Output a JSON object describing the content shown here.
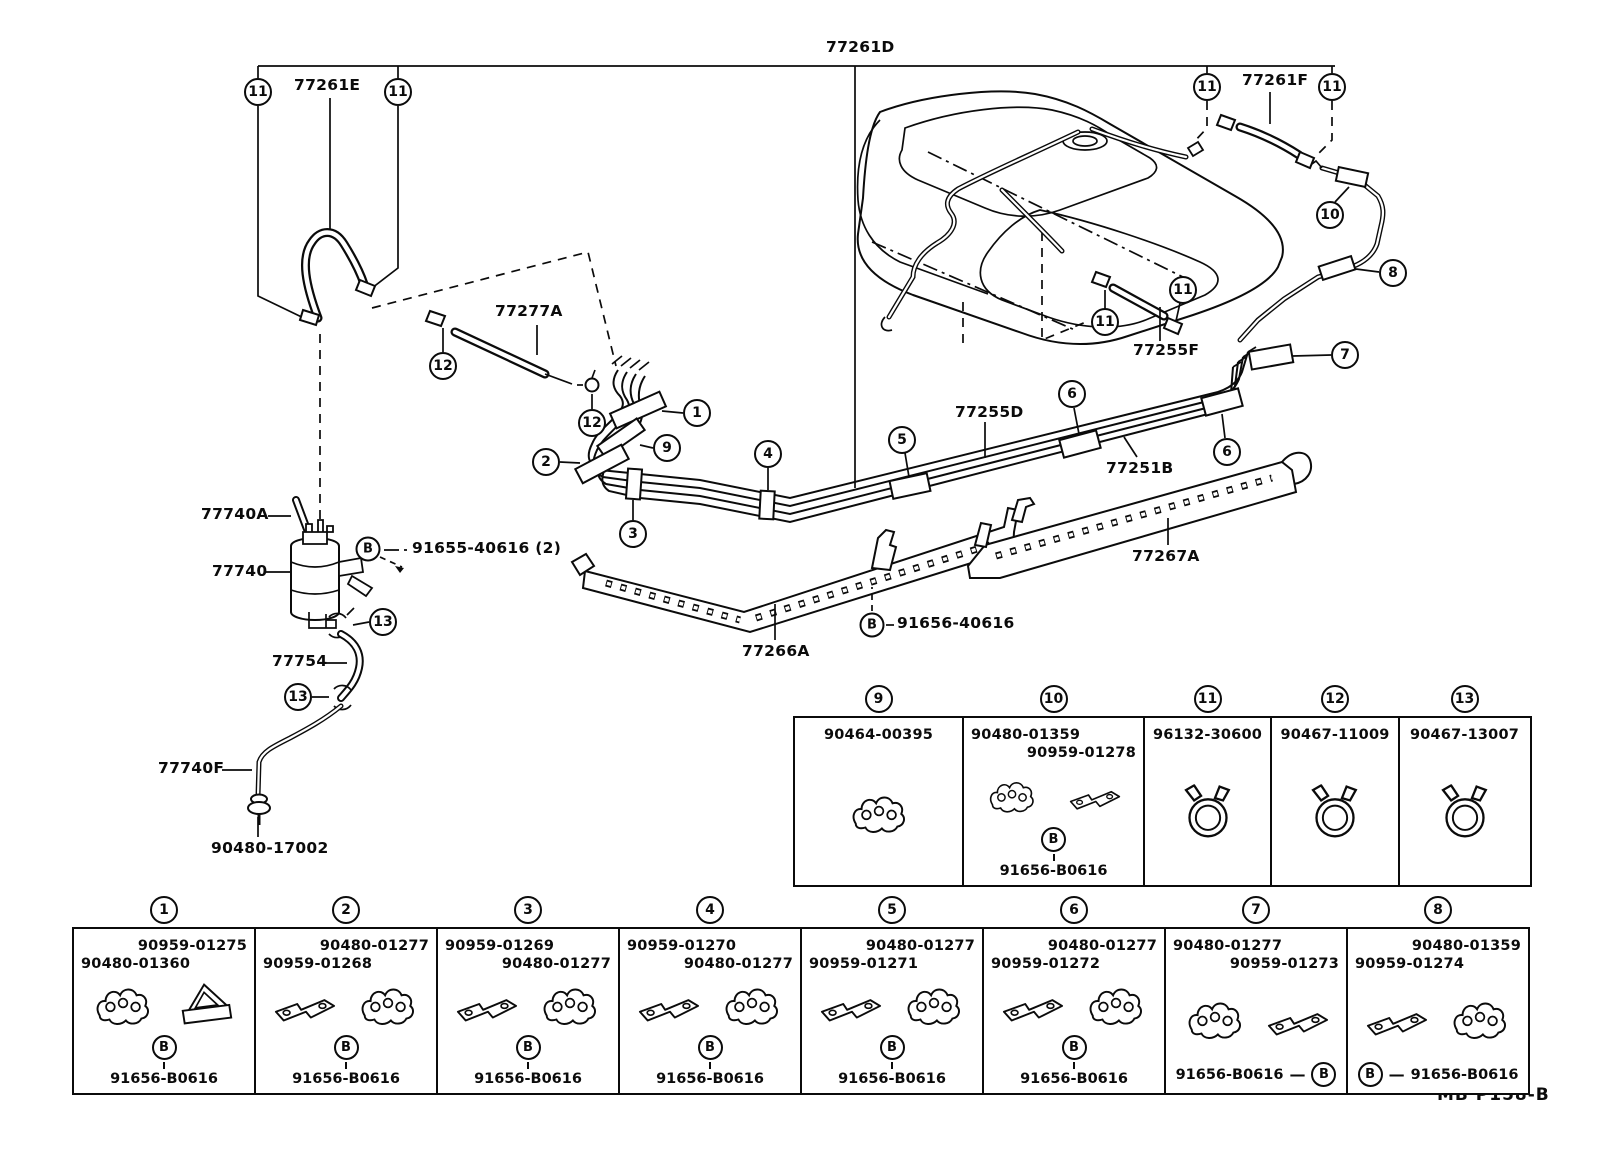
{
  "footer": {
    "text": "MB P158-B"
  },
  "labels": {
    "d77261D": "77261D",
    "d77261E": "77261E",
    "d77261F": "77261F",
    "d77277A": "77277A",
    "d77255F": "77255F",
    "d77255D": "77255D",
    "d77251B": "77251B",
    "d77740A": "77740A",
    "d77740": "77740",
    "d91655": "91655-40616 (2)",
    "d77754": "77754",
    "d77740F": "77740F",
    "d9048017002": "90480-17002",
    "d77266A": "77266A",
    "d77267A": "77267A",
    "d91656": "91656-40616"
  },
  "callouts": {
    "c11a": "11",
    "c11b": "11",
    "c11c": "11",
    "c11d": "11",
    "c11e": "11",
    "c11f": "11",
    "c12a": "12",
    "c12b": "12",
    "c13a": "13",
    "c13b": "13",
    "c1": "1",
    "c2": "2",
    "c3": "3",
    "c4": "4",
    "c5": "5",
    "c6a": "6",
    "c6b": "6",
    "c7": "7",
    "c8": "8",
    "c9": "9",
    "c10": "10",
    "bFilter": "B",
    "bPlate": "B"
  },
  "icons": {
    "clip": "tube-clip-icon",
    "bracket": "mount-bracket-icon",
    "triangle": "triangle-bracket-icon",
    "clamp": "hose-clamp-icon",
    "grommet": "grommet-icon"
  },
  "legend1": {
    "cells": [
      {
        "num": "9",
        "p1": "90464-00395"
      },
      {
        "num": "10",
        "p1": "90480-01359",
        "p2": "90959-01278",
        "b": "B",
        "bolt": "91656-B0616"
      },
      {
        "num": "11",
        "p1": "96132-30600"
      },
      {
        "num": "12",
        "p1": "90467-11009"
      },
      {
        "num": "13",
        "p1": "90467-13007"
      }
    ]
  },
  "legend2": {
    "cells": [
      {
        "num": "1",
        "p1": "90959-01275",
        "p2": "90480-01360",
        "b": "B",
        "bolt": "91656-B0616"
      },
      {
        "num": "2",
        "p1": "90480-01277",
        "p2": "90959-01268",
        "b": "B",
        "bolt": "91656-B0616"
      },
      {
        "num": "3",
        "p1": "90959-01269",
        "p2": "90480-01277",
        "b": "B",
        "bolt": "91656-B0616"
      },
      {
        "num": "4",
        "p1": "90959-01270",
        "p2": "90480-01277",
        "b": "B",
        "bolt": "91656-B0616"
      },
      {
        "num": "5",
        "p1": "90480-01277",
        "p2": "90959-01271",
        "b": "B",
        "bolt": "91656-B0616"
      },
      {
        "num": "6",
        "p1": "90480-01277",
        "p2": "90959-01272",
        "b": "B",
        "bolt": "91656-B0616"
      },
      {
        "num": "7",
        "p1": "90480-01277",
        "p2": "90959-01273",
        "b": "B",
        "bolt": "91656-B0616"
      },
      {
        "num": "8",
        "p1": "90480-01359",
        "p2": "90959-01274",
        "b": "B",
        "bolt": "91656-B0616"
      }
    ]
  }
}
